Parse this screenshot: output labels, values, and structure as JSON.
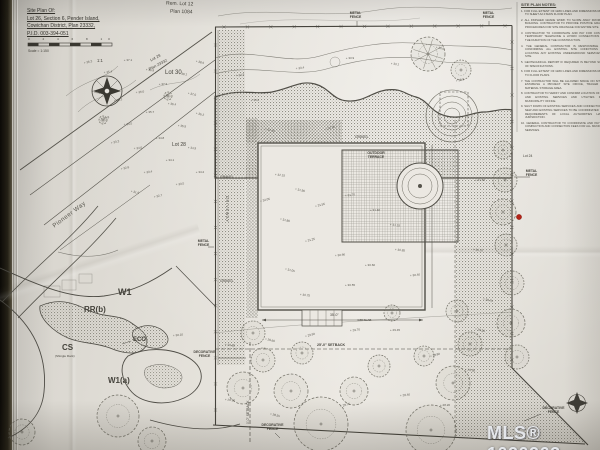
{
  "title_block": {
    "line1": "Site Plan Of:",
    "line2": "Lot 26, Section 6, Pender Island,",
    "line3": "Cowichan District, Plan 23332,",
    "line4": "P.I.D. 003-394-051",
    "scale_ticks": "0 2 4 6 8 10",
    "scale_text": "Scale = 1:150"
  },
  "compass": {
    "label": "1:1"
  },
  "lots": {
    "rem_lot12": "Rem. Lot 12",
    "plan_1084": "Plan 1084",
    "lot30": "Lot 30",
    "lot29": "Lot 29",
    "plan_23332": "Plan 23332",
    "lot28": "Lot 28",
    "lot24": "Lot 24"
  },
  "street": {
    "pioneer_way": "Pioneer Way"
  },
  "zoning": {
    "w1": "W1",
    "rrb": "RR(b)",
    "cs": "CS",
    "cs_sub": "(Shingle Rock)",
    "eco": "ECO",
    "w1a": "W1(a)"
  },
  "fences": {
    "metal": "METAL FENCE",
    "decorative": "DECORATIVE FENCE"
  },
  "site": {
    "gravel": "GRAVEL",
    "driveway": "DRIVEWAY",
    "outdoor_terrace": "OUTDOOR TERRACE",
    "setback_25": "25'-0\" SETBACK",
    "setback_0": "0'-0\" SETBACK",
    "dim_35": "35'-0\"",
    "slab": "4.88 SLAB"
  },
  "notes": {
    "header": "SITE PLAN NOTES:",
    "items": [
      "FOR FULL EXTENT OF GRID LINES AND DIMENSIONS REFER TO SHEET A2.0 MAIN FLOOR PLAN.",
      "ALL FINISHED GRADE WORK TO SLOPE AWAY FROM THE BUILDING. CONTRACTOR TO PROVIDE POSITIVE GRADING PROCEDURES FOR SITE DRAINAGE FOR ENTIRE SITE.",
      "CONTRACTOR TO COORDINATE AND PAY FOR COST OF TEMPORARY TELEPHONE & HYDRO CONNECTIONS FOR THE DURATION OF THE CONSTRUCTION.",
      "THE GENERAL CONTRACTOR IS RESPONSIBLE FOR CONFIRMING ALL EXISTING SITE CONDITIONS AND LOCATING ANY EXISTING UNDERGROUND SERVICES ON SITE.",
      "GEOTECHNICAL REPORT IF REQUIRED IS BEYOND SCOPE OF SPECIFICATIONS.",
      "FOR FULL EXTENT OF GRID LINES AND DIMENSIONS REFER TO FLOOR PLANS.",
      "THE CONTRACTOR WILL BE ALLOWED SPACE ON SITE TO ESTABLISH A PROJECT SITE OFFICE, TRAILER AND MATERIAL STORAGE AREA.",
      "CONTRACTOR TO VERIFY AND CONFIRM LOCATION OF NEW AND EXISTING SERVICES AND UTILITIES FROM MUNICIPALITY OFFICE.",
      "SHUT DOWN OF EXISTING SERVICES AND CONNECTION OF NEW AND EXISTING SERVICES TO BE COORDINATED WITH REQUIREMENTS OF LOCAL AUTHORITIES HAVING JURISDICTION.",
      "GENERAL CONTRACTOR TO COORDINATE AND PAY FOR COMPACTION AND CONNECTION FEES FOR ALL MUNICIPAL SERVICES."
    ]
  },
  "watermark": "MLS® 1020263",
  "colors": {
    "paper": "#e7e4de",
    "ink": "#4d4b45",
    "red_marker": "#b32318",
    "watermark": "#eef0f4"
  },
  "survey": {
    "red_marker": [
      519,
      217
    ],
    "spot_elevations": [
      [
        88,
        62,
        "36.2"
      ],
      [
        108,
        72,
        "35.4"
      ],
      [
        128,
        60,
        "37.1"
      ],
      [
        150,
        70,
        "36.8"
      ],
      [
        96,
        92,
        "34.9"
      ],
      [
        118,
        100,
        "35.2"
      ],
      [
        140,
        92,
        "36.0"
      ],
      [
        163,
        84,
        "37.3"
      ],
      [
        183,
        74,
        "38.1"
      ],
      [
        200,
        62,
        "38.6"
      ],
      [
        105,
        118,
        "33.8"
      ],
      [
        128,
        124,
        "34.5"
      ],
      [
        150,
        112,
        "35.7"
      ],
      [
        172,
        104,
        "36.4"
      ],
      [
        192,
        94,
        "37.0"
      ],
      [
        115,
        142,
        "33.2"
      ],
      [
        138,
        148,
        "34.0"
      ],
      [
        160,
        138,
        "34.8"
      ],
      [
        182,
        126,
        "35.5"
      ],
      [
        200,
        114,
        "36.2"
      ],
      [
        125,
        168,
        "32.6"
      ],
      [
        148,
        172,
        "33.4"
      ],
      [
        170,
        160,
        "34.1"
      ],
      [
        192,
        148,
        "34.9"
      ],
      [
        135,
        192,
        "31.9"
      ],
      [
        158,
        196,
        "32.7"
      ],
      [
        180,
        184,
        "33.5"
      ],
      [
        200,
        172,
        "34.2"
      ],
      [
        280,
        175,
        "32.15"
      ],
      [
        300,
        190,
        "31.90"
      ],
      [
        320,
        205,
        "31.55"
      ],
      [
        350,
        195,
        "31.70"
      ],
      [
        375,
        210,
        "31.40"
      ],
      [
        395,
        225,
        "31.15"
      ],
      [
        285,
        220,
        "31.80"
      ],
      [
        310,
        240,
        "31.25"
      ],
      [
        340,
        255,
        "30.90"
      ],
      [
        370,
        265,
        "30.60"
      ],
      [
        400,
        250,
        "30.85"
      ],
      [
        290,
        270,
        "31.05"
      ],
      [
        265,
        200,
        "32.05"
      ],
      [
        415,
        275,
        "30.40"
      ],
      [
        350,
        285,
        "30.55"
      ],
      [
        305,
        295,
        "30.75"
      ],
      [
        270,
        130,
        "32.60"
      ],
      [
        330,
        128,
        "32.35"
      ],
      [
        300,
        68,
        "33.4"
      ],
      [
        350,
        58,
        "33.9"
      ],
      [
        395,
        64,
        "33.1"
      ],
      [
        440,
        48,
        "34.0"
      ],
      [
        460,
        80,
        "32.9"
      ],
      [
        240,
        75,
        "34.3"
      ],
      [
        255,
        100,
        "33.6"
      ],
      [
        230,
        345,
        "29.85"
      ],
      [
        270,
        340,
        "29.60"
      ],
      [
        310,
        335,
        "29.90"
      ],
      [
        355,
        330,
        "29.70"
      ],
      [
        395,
        330,
        "29.45"
      ],
      [
        230,
        400,
        "28.90"
      ],
      [
        275,
        415,
        "28.55"
      ],
      [
        345,
        405,
        "28.75"
      ],
      [
        405,
        395,
        "28.40"
      ],
      [
        445,
        405,
        "28.20"
      ],
      [
        470,
        370,
        "28.95"
      ],
      [
        480,
        330,
        "29.30"
      ],
      [
        435,
        355,
        "28.80"
      ],
      [
        178,
        335,
        "30.10"
      ],
      [
        480,
        180,
        "31.60"
      ],
      [
        478,
        250,
        "30.20"
      ],
      [
        488,
        300,
        "29.75"
      ]
    ],
    "trees": [
      [
        428,
        54,
        17,
        "b"
      ],
      [
        461,
        70,
        10
      ],
      [
        103,
        120,
        4
      ],
      [
        168,
        96,
        4
      ],
      [
        22,
        432,
        13
      ],
      [
        503,
        150,
        9
      ],
      [
        505,
        180,
        12
      ],
      [
        503,
        212,
        13
      ],
      [
        506,
        245,
        11
      ],
      [
        512,
        283,
        12
      ],
      [
        511,
        323,
        14
      ],
      [
        517,
        357,
        12
      ],
      [
        118,
        416,
        21
      ],
      [
        152,
        441,
        14
      ],
      [
        243,
        388,
        16
      ],
      [
        263,
        360,
        12
      ],
      [
        291,
        391,
        17
      ],
      [
        253,
        333,
        12
      ],
      [
        321,
        424,
        27
      ],
      [
        302,
        353,
        11
      ],
      [
        354,
        391,
        14
      ],
      [
        379,
        366,
        11
      ],
      [
        431,
        430,
        25
      ],
      [
        453,
        383,
        17
      ],
      [
        470,
        344,
        12
      ],
      [
        424,
        356,
        10
      ],
      [
        392,
        313,
        8
      ],
      [
        457,
        311,
        11
      ]
    ]
  }
}
